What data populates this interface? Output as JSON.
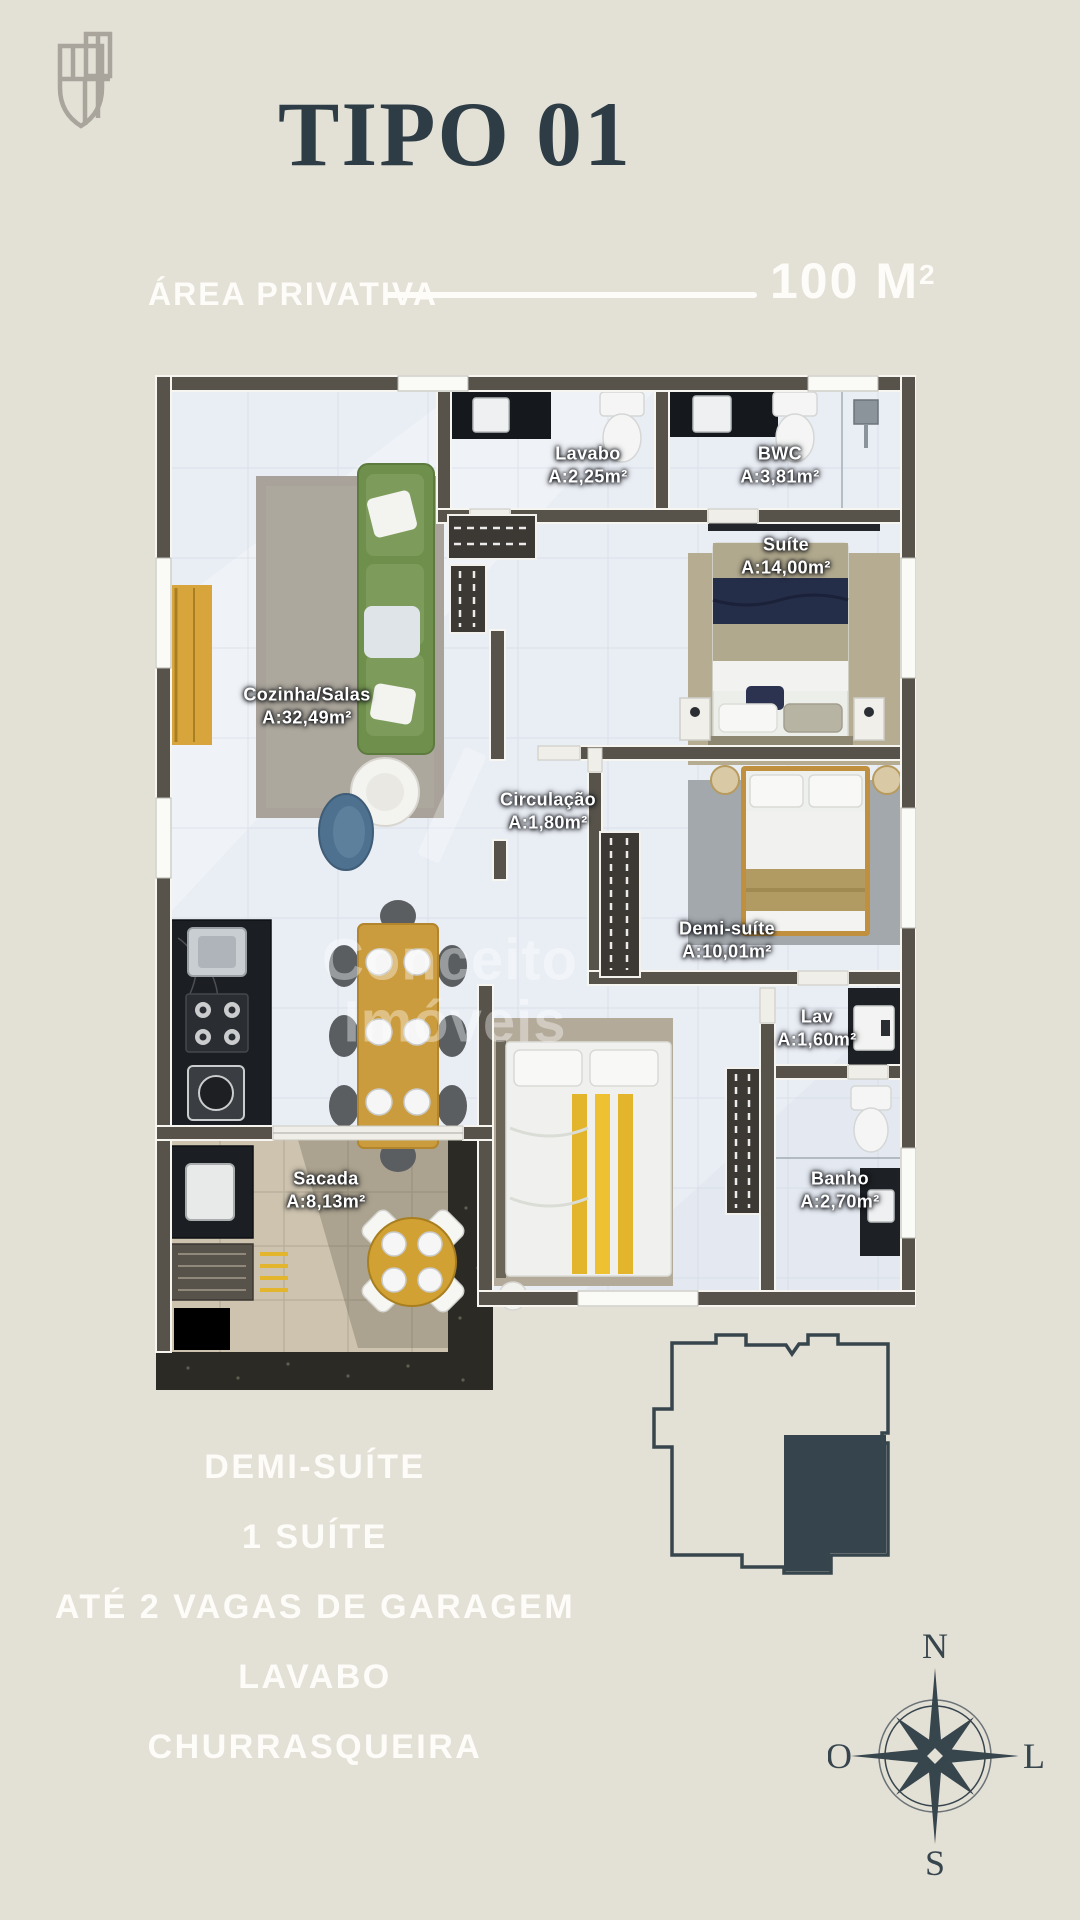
{
  "header": {
    "title": "TIPO 01",
    "area_label": "ÁREA PRIVATIVA",
    "area_value": "100 M",
    "area_sup": "2"
  },
  "floorplan": {
    "watermark": {
      "line1": "Conceito",
      "line2": "Imóveis"
    },
    "rooms": [
      {
        "id": "lavabo",
        "name": "Lavabo",
        "area": "A:2,25m²"
      },
      {
        "id": "bwc",
        "name": "BWC",
        "area": "A:3,81m²"
      },
      {
        "id": "suite",
        "name": "Suíte",
        "area": "A:14,00m²"
      },
      {
        "id": "cozinha",
        "name": "Cozinha/Salas",
        "area": "A:32,49m²"
      },
      {
        "id": "circulacao",
        "name": "Circulação",
        "area": "A:1,80m²"
      },
      {
        "id": "demi",
        "name": "Demi-suíte",
        "area": "A:10,01m²"
      },
      {
        "id": "lav",
        "name": "Lav",
        "area": "A:1,60m²"
      },
      {
        "id": "banho",
        "name": "Banho",
        "area": "A:2,70m²"
      },
      {
        "id": "sacada",
        "name": "Sacada",
        "area": "A:8,13m²"
      }
    ]
  },
  "features": [
    "DEMI-SUÍTE",
    "1 SUÍTE",
    "ATÉ 2 VAGAS DE GARAGEM",
    "LAVABO",
    "CHURRASQUEIRA"
  ],
  "compass": {
    "north": "N",
    "south": "S",
    "east": "L",
    "west": "O"
  },
  "colors": {
    "background": "#e3e0d6",
    "ink": "#2d3c45",
    "text_white": "#fdfcf8",
    "wall": "#57534b",
    "floor": "#e9edf4",
    "balcony_tile": "#cdc3af",
    "pebble": "#2c2a24",
    "sofa_green": "#6f8f4d",
    "wood": "#cb9c3d",
    "gold_accent": "#e3b52c",
    "navy": "#252e49",
    "counter_dark": "#1b1e22",
    "logo_gray": "#a9a59c"
  }
}
